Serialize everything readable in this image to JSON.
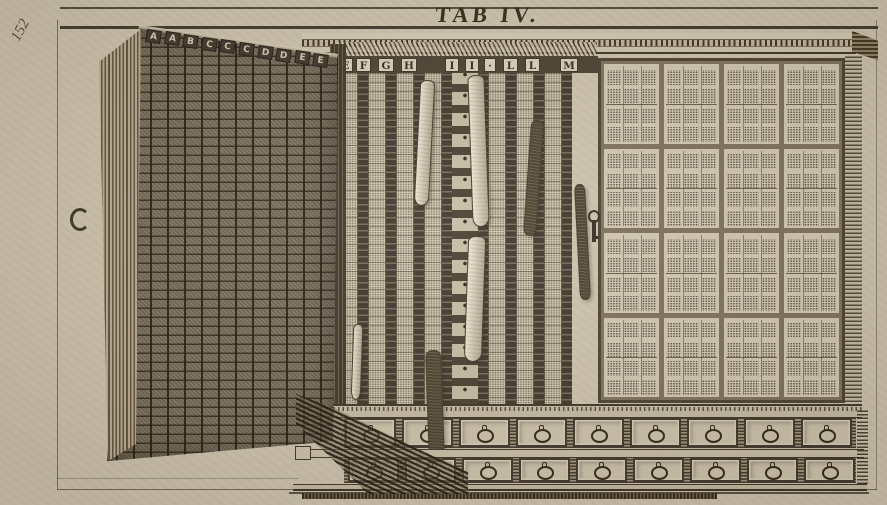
{
  "plate": {
    "folio_number": "152",
    "title": "TAB IV.",
    "paper_color": "#cfc5b1",
    "ink_color": "#33291c"
  },
  "cabinet": {
    "door": {
      "letters": [
        "A",
        "A",
        "B",
        "C",
        "C",
        "C",
        "D",
        "D",
        "E",
        "E"
      ],
      "handle_icon": "c-ring-handle"
    },
    "middle_rack": {
      "letters": [
        "E",
        "F",
        "G",
        "H",
        "I",
        "I",
        "·",
        "L",
        "L",
        "M"
      ],
      "strip_count": 16,
      "hanging_specimens": 7
    },
    "right_panel": {
      "pane_rows": 4,
      "pane_cols": 4,
      "sheets_per_pane": 3,
      "key_icon": "hanging-key"
    },
    "drawers": {
      "rows": 2,
      "per_row": 9,
      "pull_icon": "ring-pull"
    }
  }
}
